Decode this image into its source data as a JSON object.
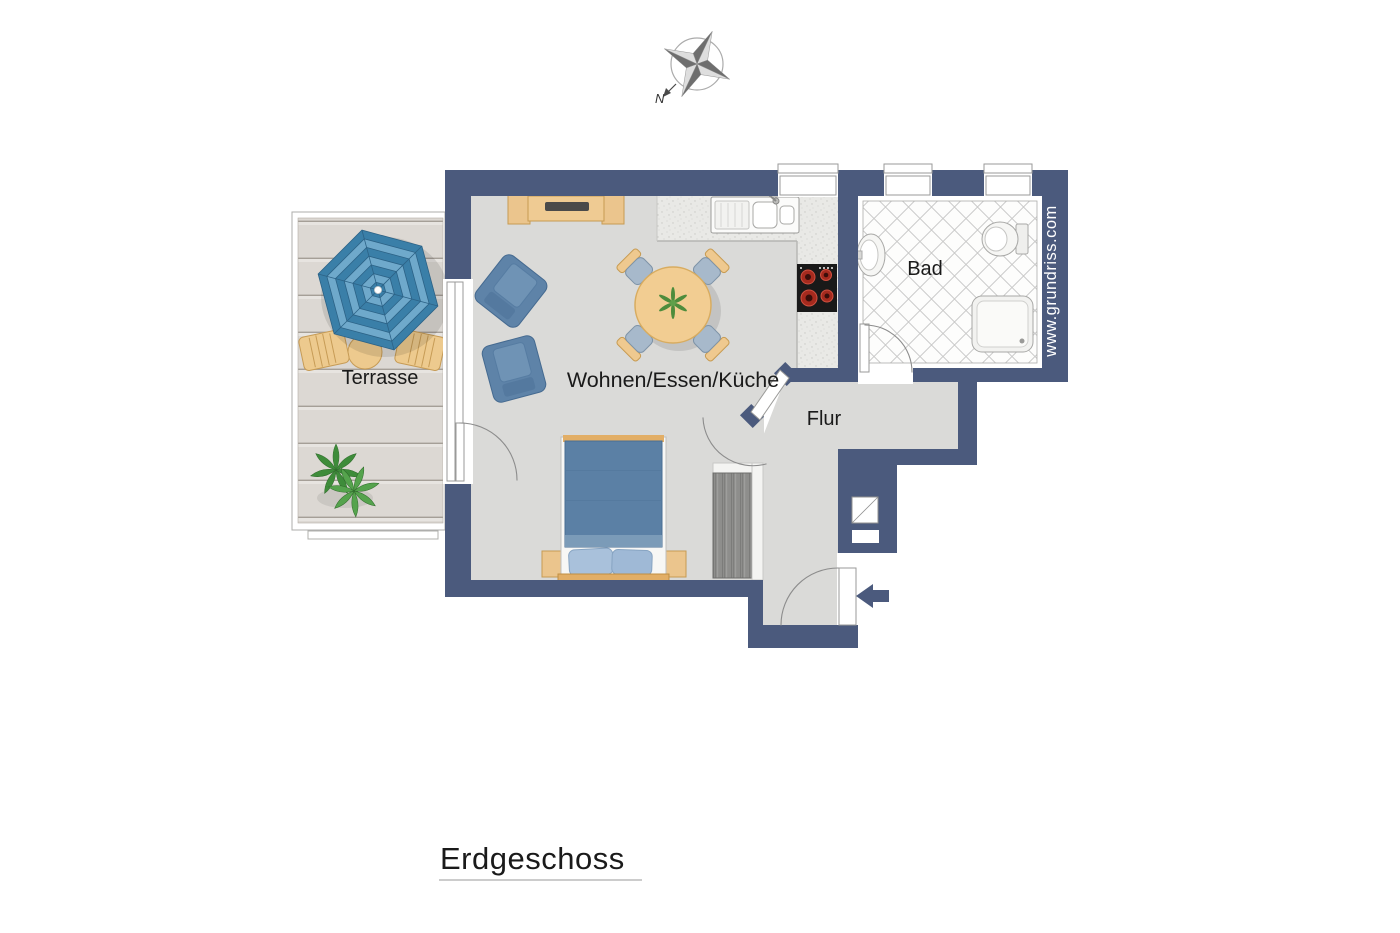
{
  "title": {
    "label": "Erdgeschoss"
  },
  "compass": {
    "north_label": "N"
  },
  "branding": {
    "website": "www.grundriss.com"
  },
  "rooms": [
    {
      "id": "wohnen-essen-kueche",
      "label": "Wohnen/Essen/Küche"
    },
    {
      "id": "flur",
      "label": "Flur"
    },
    {
      "id": "bad",
      "label": "Bad"
    },
    {
      "id": "terrasse",
      "label": "Terrasse"
    }
  ],
  "colors": {
    "wall": "#4B5A7D",
    "floor": "#DADAD8",
    "terrace_plank": "#DCD8D3",
    "tile_line": "#C8C8C8",
    "furniture_blue": "#5E83A8",
    "bed_blue": "#5B80A5",
    "wood": "#EBC58D",
    "umbrella_dark": "#3A7FA8",
    "umbrella_light": "#6FA9CB",
    "plant_green": "#4E9440",
    "text": "#1A1A1A",
    "brand_text": "#FFFFFF"
  },
  "icons": {
    "compass-rose": "four-point-star",
    "entrance-arrow": "left-arrow"
  }
}
